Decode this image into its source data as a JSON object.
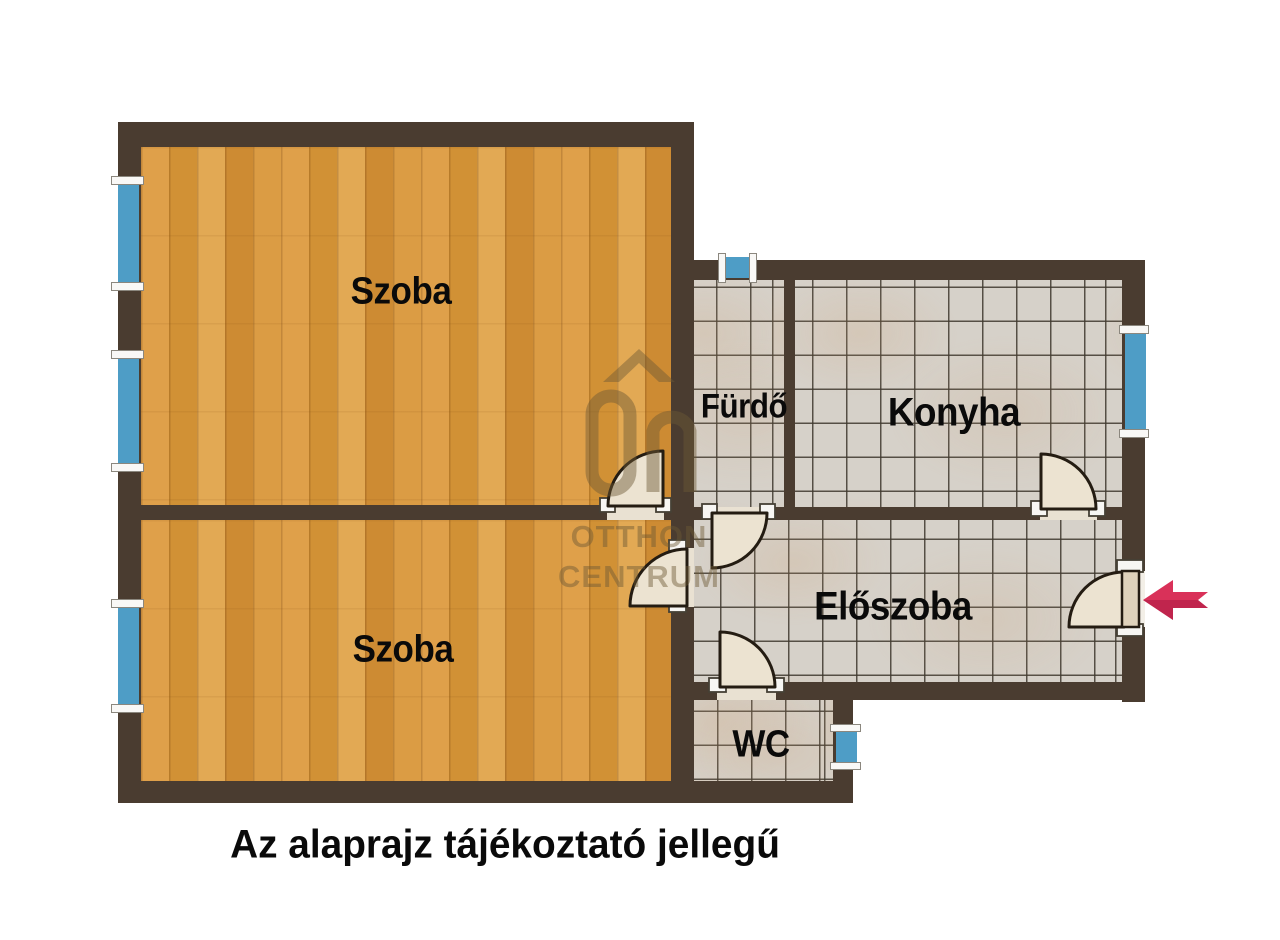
{
  "caption": "Az alaprajz tájékoztató jellegű",
  "rooms": {
    "szoba_upper": {
      "label": "Szoba",
      "floor": "wood-parquet"
    },
    "szoba_lower": {
      "label": "Szoba",
      "floor": "wood-parquet"
    },
    "furdo": {
      "label": "Fürdő",
      "floor": "tile"
    },
    "konyha": {
      "label": "Konyha",
      "floor": "tile"
    },
    "eloszoba": {
      "label": "Előszoba",
      "floor": "tile"
    },
    "wc": {
      "label": "WC",
      "floor": "tile"
    }
  },
  "watermark": {
    "logo": "otthon-centrum-roof-logo",
    "line1": "OTTHON",
    "line2": "CENTRUM"
  },
  "icons": {
    "entrance_arrow": "left-arrow-entrance-icon"
  },
  "colors": {
    "wall": "#4a3c30",
    "wood": "#d8993f",
    "tile": "#d6d1c9",
    "window_glass": "#4e9dc6",
    "window_frame": "#f9f8f6",
    "door_fill": "#ece3d1",
    "door_outline": "#241c12",
    "arrow": "#d93159",
    "arrow_dark": "#ab1c43",
    "watermark": "#6d5935",
    "label": "#0a0a0a"
  }
}
